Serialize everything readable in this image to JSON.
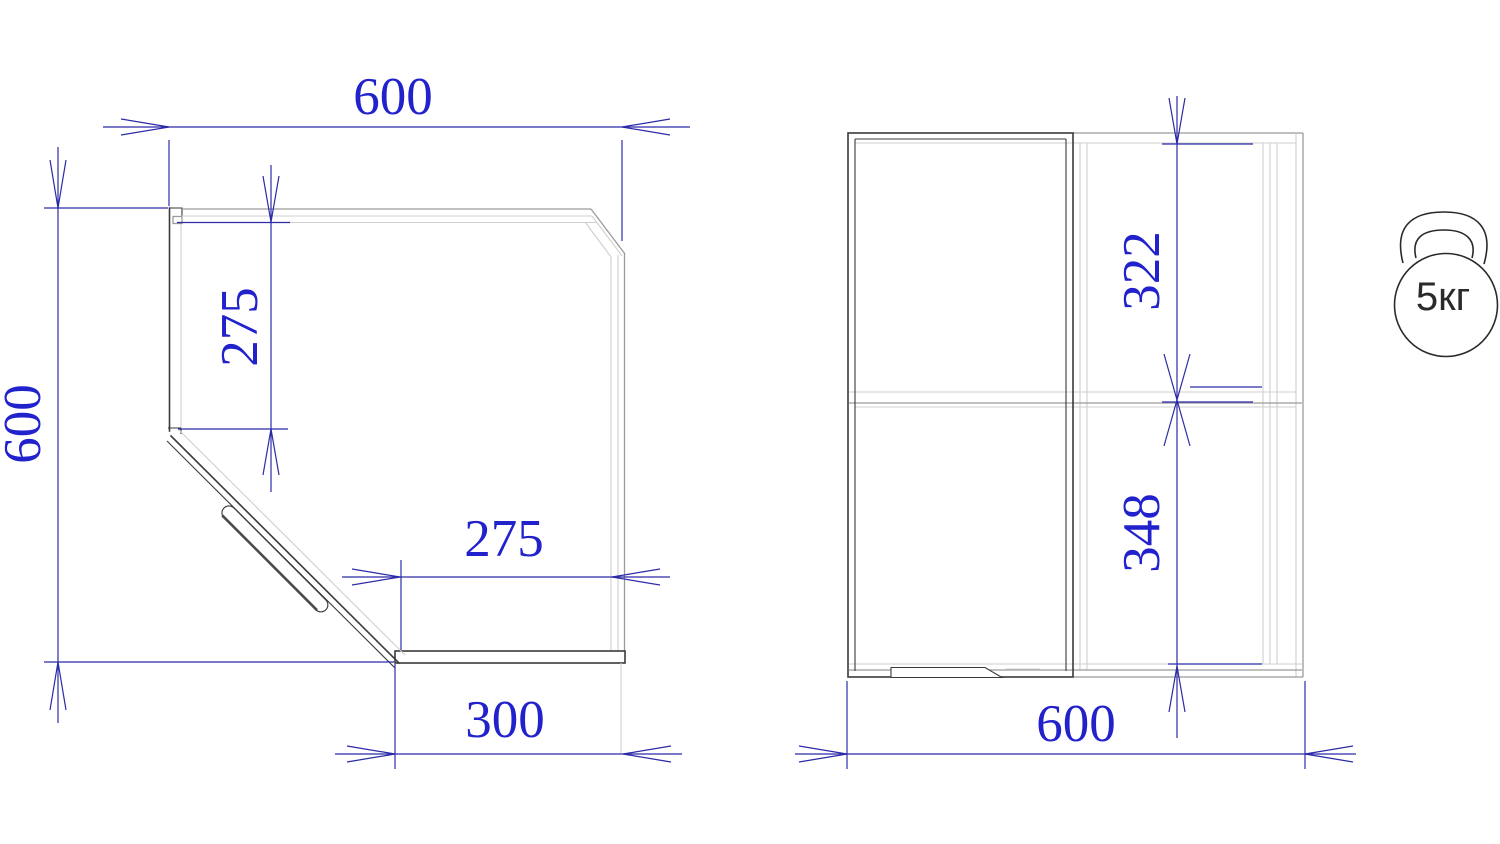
{
  "colors": {
    "background": "#ffffff",
    "dimension_line": "#2b2ba8",
    "dimension_text": "#2222cc",
    "outline_dark": "#3a3a3a",
    "outline_light": "#cfcfcf",
    "outline_medium": "#9b9b9b"
  },
  "plan_view": {
    "dim_top_width": "600",
    "dim_left_depth": "600",
    "dim_side_panel_depth": "275",
    "dim_opening_width": "275",
    "dim_bottom_panel_width": "300"
  },
  "front_view": {
    "dim_upper_section_height": "322",
    "dim_lower_section_height": "348",
    "dim_width": "600"
  },
  "weight_icon": {
    "label": "5кг"
  }
}
